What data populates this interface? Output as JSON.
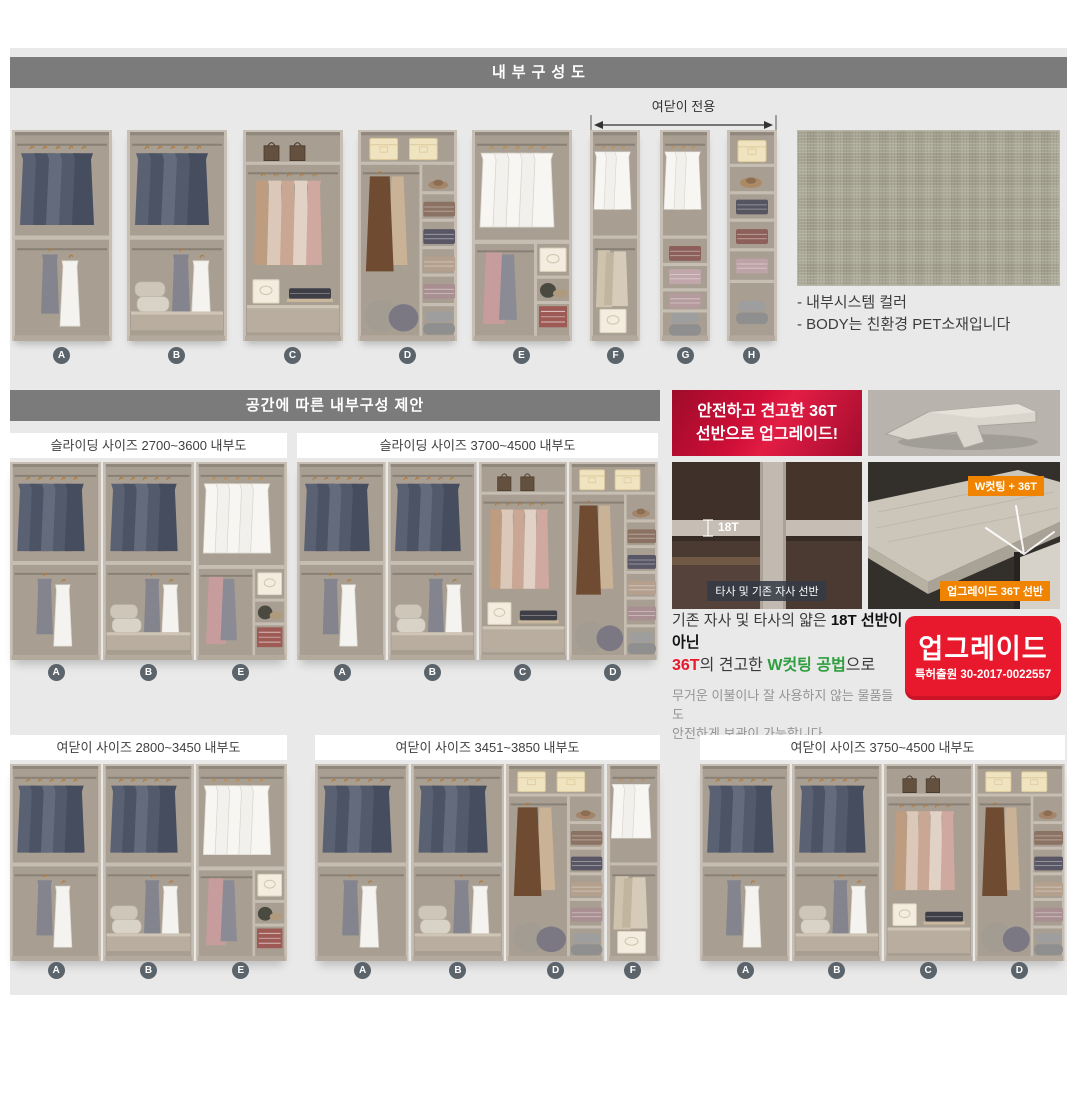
{
  "header": {
    "title": "내부구성도"
  },
  "top_row": {
    "bracket_label": "여닫이 전용",
    "units": [
      "A",
      "B",
      "C",
      "D",
      "E",
      "F",
      "G",
      "H"
    ]
  },
  "swatch_notes": {
    "line1": "- 내부시스템 컬러",
    "line2": "- BODY는 친환경 PET소재입니다"
  },
  "section_suggest": {
    "title": "공간에 따른 내부구성 제안"
  },
  "sliding_panels": [
    {
      "title": "슬라이딩 사이즈 2700~3600 내부도",
      "labels": [
        "A",
        "B",
        "E"
      ]
    },
    {
      "title": "슬라이딩 사이즈 3700~4500 내부도",
      "labels": [
        "A",
        "B",
        "C",
        "D"
      ]
    }
  ],
  "hinged_panels": [
    {
      "title": "여닫이 사이즈 2800~3450 내부도",
      "labels": [
        "A",
        "B",
        "E"
      ]
    },
    {
      "title": "여닫이 사이즈 3451~3850 내부도",
      "labels": [
        "A",
        "B",
        "D",
        "F"
      ]
    },
    {
      "title": "여닫이 사이즈 3750~4500 내부도",
      "labels": [
        "A",
        "B",
        "C",
        "D"
      ]
    }
  ],
  "upgrade": {
    "banner_line1": "안전하고 견고한 36T",
    "banner_line2": "선반으로 업그레이드!",
    "old_shelf_thickness": "18T",
    "old_shelf_badge": "타사 및 기존 자사 선반",
    "new_shelf_badge_top": "W컷팅 + 36T",
    "new_shelf_badge_bottom": "업그레이드 36T 선반",
    "desc_line1_normal": "기존 자사 및 타사의 얇은 ",
    "desc_line1_bold": "18T 선반이 아닌",
    "desc_line2_red": "36T",
    "desc_line2_mid": "의 견고한 ",
    "desc_line2_green": "W컷팅 공법",
    "desc_line2_end": "으로",
    "desc_line3": "무거운 이불이나 잘 사용하지 않는 물품들도",
    "desc_line4": "안전하게 보관이 가능합니다.",
    "stamp_title": "업그레이드",
    "stamp_sub": "특허출원 30-2017-0022557"
  },
  "colors": {
    "accent_red": "#e8192c",
    "badge_orange": "#f08300",
    "bar_gray": "#7b7b7b",
    "swatch_linen": "#a7a492"
  }
}
